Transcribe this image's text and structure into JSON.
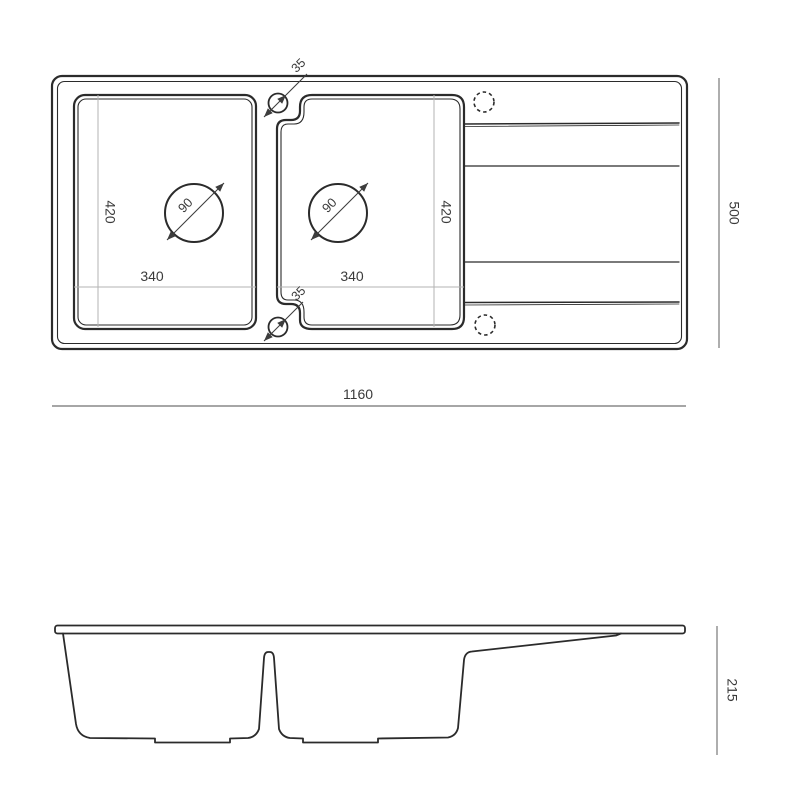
{
  "top_view": {
    "overall_width": "1160",
    "overall_depth": "500",
    "left_bowl": {
      "width": "340",
      "length": "420",
      "drain_diameter": "90"
    },
    "right_bowl": {
      "width": "340",
      "length": "420",
      "drain_diameter": "90"
    },
    "overflow_hole_top": "35",
    "overflow_hole_bottom": "35"
  },
  "side_view": {
    "overall_height": "215"
  },
  "colors": {
    "outline": "#2b2b2b",
    "dimension_line": "#9a9a9a",
    "inner_dimension_line": "#b3b3b3",
    "label_text": "#3a3a3a",
    "background": "#ffffff"
  }
}
